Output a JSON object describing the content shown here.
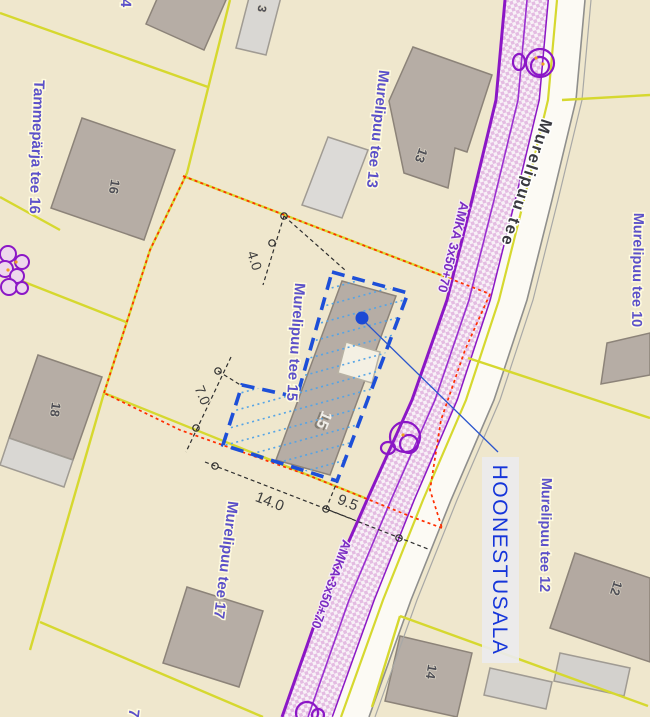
{
  "map": {
    "street_name": "Murelipuu tee",
    "cable_label": "AMKA 3x50+70",
    "building_area_label": "HOONESTUSALA",
    "parcel_labels": {
      "tammeparja_tee_16": "Tammepärja tee 16",
      "murelipuu_tee_13": "Murelipuu tee 13",
      "murelipuu_tee_15": "Murelipuu tee 15",
      "murelipuu_tee_10": "Murelipuu tee 10",
      "murelipuu_tee_12": "Murelipuu tee 12",
      "murelipuu_tee_17": "Murelipuu tee 17",
      "partial_top": "4",
      "partial_bottom": "7"
    },
    "house_numbers": {
      "b13": "13",
      "b16": "16",
      "b18": "18",
      "b12": "12",
      "b14": "14",
      "b15": "15",
      "partial_top_small": "3"
    },
    "dimensions": {
      "setback_top": "4.0",
      "setback_left": "7.0",
      "width_bottom": "14.0",
      "gap_road": "9.5"
    },
    "colors": {
      "background": "#efe7cd",
      "cadastral_line": "#d6d82f",
      "road_utility_purple": "#8b17c6",
      "building_fill": "#b6ada5",
      "building_light_fill": "#d9d7d3",
      "planned_boundary_red": "#ff2e00",
      "building_area_blue": "#1d4fd8",
      "hatch_blue": "#55a4e6",
      "label_purple": "#5b50c9",
      "hoonestusala_blue": "#1535da"
    }
  }
}
